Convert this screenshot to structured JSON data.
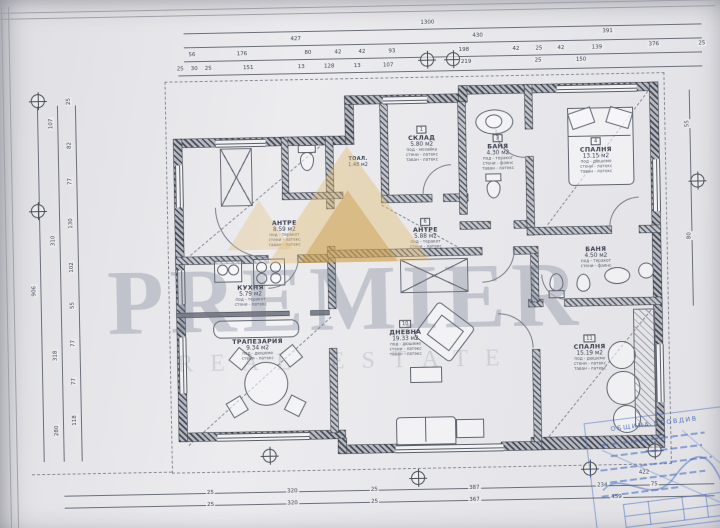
{
  "document": {
    "type": "Архитектурен план - разпределение",
    "total_width_label": "1300",
    "total_height_label": "906"
  },
  "rooms": [
    {
      "number": "1",
      "name": "СКЛАД",
      "area": "5.80 м2",
      "f1": "под - мозайка",
      "f2": "стени - латекс",
      "f3": "таван - латекс"
    },
    {
      "number": "2",
      "name": "ТОАЛ.",
      "area": "1.48 м2",
      "f1": "",
      "f2": "",
      "f3": ""
    },
    {
      "number": "3",
      "name": "БАНЯ",
      "area": "4.30 м2",
      "f1": "под - теракот",
      "f2": "стени - фаянс",
      "f3": "таван - латекс"
    },
    {
      "number": "4",
      "name": "СПАЛНЯ",
      "area": "13.15 м2",
      "f1": "под - дюшеме",
      "f2": "стени - латекс",
      "f3": "таван - латекс"
    },
    {
      "number": "5",
      "name": "АНТРЕ",
      "area": "8.59 м2",
      "f1": "под - теракот",
      "f2": "стени - латекс",
      "f3": "таван - латекс"
    },
    {
      "number": "6",
      "name": "АНТРЕ",
      "area": "5.88 м2",
      "f1": "под - теракот",
      "f2": "стени - латекс",
      "f3": "таван - латекс"
    },
    {
      "number": "7",
      "name": "БАНЯ",
      "area": "4.50 м2",
      "f1": "под - теракот",
      "f2": "стени - фаянс",
      "f3": "таван - латекс"
    },
    {
      "number": "8",
      "name": "КУХНЯ",
      "area": "5.79 м2",
      "f1": "под - теракот",
      "f2": "стени - латекс",
      "f3": "таван - латекс"
    },
    {
      "number": "9",
      "name": "ТРАПЕЗАРИЯ",
      "area": "9.34 м2",
      "f1": "под - дюшеме",
      "f2": "стени - латекс",
      "f3": "таван - латекс"
    },
    {
      "number": "10",
      "name": "ДНЕВНА",
      "area": "19.33 м2",
      "f1": "под - дюшеме",
      "f2": "стени - латекс",
      "f3": "таван - латекс"
    },
    {
      "number": "11",
      "name": "СПАЛНЯ",
      "area": "15.19 м2",
      "f1": "под - дюшеме",
      "f2": "стени - латекс",
      "f3": "таван - латекс"
    }
  ],
  "dimensions": {
    "labels": [
      {
        "x": 432,
        "y": 24,
        "t": "1300"
      },
      {
        "x": 300,
        "y": 38,
        "t": "427"
      },
      {
        "x": 482,
        "y": 38,
        "t": "430"
      },
      {
        "x": 612,
        "y": 36,
        "t": "391"
      },
      {
        "x": 196,
        "y": 52,
        "t": "56"
      },
      {
        "x": 246,
        "y": 52,
        "t": "176"
      },
      {
        "x": 312,
        "y": 52,
        "t": "80"
      },
      {
        "x": 342,
        "y": 52,
        "t": "42"
      },
      {
        "x": 366,
        "y": 52,
        "t": "42"
      },
      {
        "x": 396,
        "y": 52,
        "t": "93"
      },
      {
        "x": 468,
        "y": 52,
        "t": "198"
      },
      {
        "x": 520,
        "y": 52,
        "t": "42"
      },
      {
        "x": 543,
        "y": 52,
        "t": "25"
      },
      {
        "x": 565,
        "y": 52,
        "t": "42"
      },
      {
        "x": 601,
        "y": 52,
        "t": "139"
      },
      {
        "x": 658,
        "y": 50,
        "t": "376"
      },
      {
        "x": 706,
        "y": 50,
        "t": "25"
      },
      {
        "x": 184,
        "y": 66,
        "t": "25"
      },
      {
        "x": 198,
        "y": 66,
        "t": "30"
      },
      {
        "x": 212,
        "y": 66,
        "t": "25"
      },
      {
        "x": 252,
        "y": 66,
        "t": "151"
      },
      {
        "x": 305,
        "y": 66,
        "t": "13"
      },
      {
        "x": 333,
        "y": 66,
        "t": "128"
      },
      {
        "x": 361,
        "y": 66,
        "t": "13"
      },
      {
        "x": 392,
        "y": 66,
        "t": "107"
      },
      {
        "x": 470,
        "y": 64,
        "t": "219"
      },
      {
        "x": 542,
        "y": 64,
        "t": "25"
      },
      {
        "x": 585,
        "y": 64,
        "t": "150"
      },
      {
        "x": 34,
        "y": 285,
        "t": "906",
        "r": 1
      },
      {
        "x": 54,
        "y": 118,
        "t": "107",
        "r": 1
      },
      {
        "x": 54,
        "y": 235,
        "t": "310",
        "r": 1
      },
      {
        "x": 54,
        "y": 350,
        "t": "318",
        "r": 1
      },
      {
        "x": 54,
        "y": 425,
        "t": "280",
        "r": 1
      },
      {
        "x": 72,
        "y": 96,
        "t": "25",
        "r": 1
      },
      {
        "x": 72,
        "y": 140,
        "t": "82",
        "r": 1
      },
      {
        "x": 72,
        "y": 176,
        "t": "77",
        "r": 1
      },
      {
        "x": 72,
        "y": 218,
        "t": "130",
        "r": 1
      },
      {
        "x": 72,
        "y": 262,
        "t": "102",
        "r": 1
      },
      {
        "x": 72,
        "y": 300,
        "t": "55",
        "r": 1
      },
      {
        "x": 72,
        "y": 338,
        "t": "77",
        "r": 1
      },
      {
        "x": 72,
        "y": 376,
        "t": "77",
        "r": 1
      },
      {
        "x": 72,
        "y": 415,
        "t": "118",
        "r": 1
      },
      {
        "x": 690,
        "y": 130,
        "t": "55",
        "r": 1
      },
      {
        "x": 690,
        "y": 242,
        "t": "80",
        "r": 1
      },
      {
        "x": 206,
        "y": 490,
        "t": "25"
      },
      {
        "x": 288,
        "y": 490,
        "t": "320"
      },
      {
        "x": 370,
        "y": 490,
        "t": "25"
      },
      {
        "x": 470,
        "y": 490,
        "t": "387"
      },
      {
        "x": 598,
        "y": 490,
        "t": "234"
      },
      {
        "x": 650,
        "y": 490,
        "t": "75"
      },
      {
        "x": 640,
        "y": 478,
        "t": "422"
      },
      {
        "x": 206,
        "y": 502,
        "t": "25"
      },
      {
        "x": 288,
        "y": 502,
        "t": "320"
      },
      {
        "x": 370,
        "y": 502,
        "t": "25"
      },
      {
        "x": 470,
        "y": 502,
        "t": "367"
      },
      {
        "x": 612,
        "y": 502,
        "t": "459"
      }
    ]
  },
  "watermark": {
    "line1": "PREMIER",
    "line2": "REAL ESTATE"
  },
  "stamp": {
    "title": "ОБЩИНА ПЛОВДИВ"
  },
  "colors": {
    "paper": "#e9e9ec",
    "ink": "#3c4150",
    "wall": "#474b55",
    "stamp_blue": "#3e66be",
    "watermark_gold": "#e0ba69",
    "watermark_gray": "#687084"
  }
}
